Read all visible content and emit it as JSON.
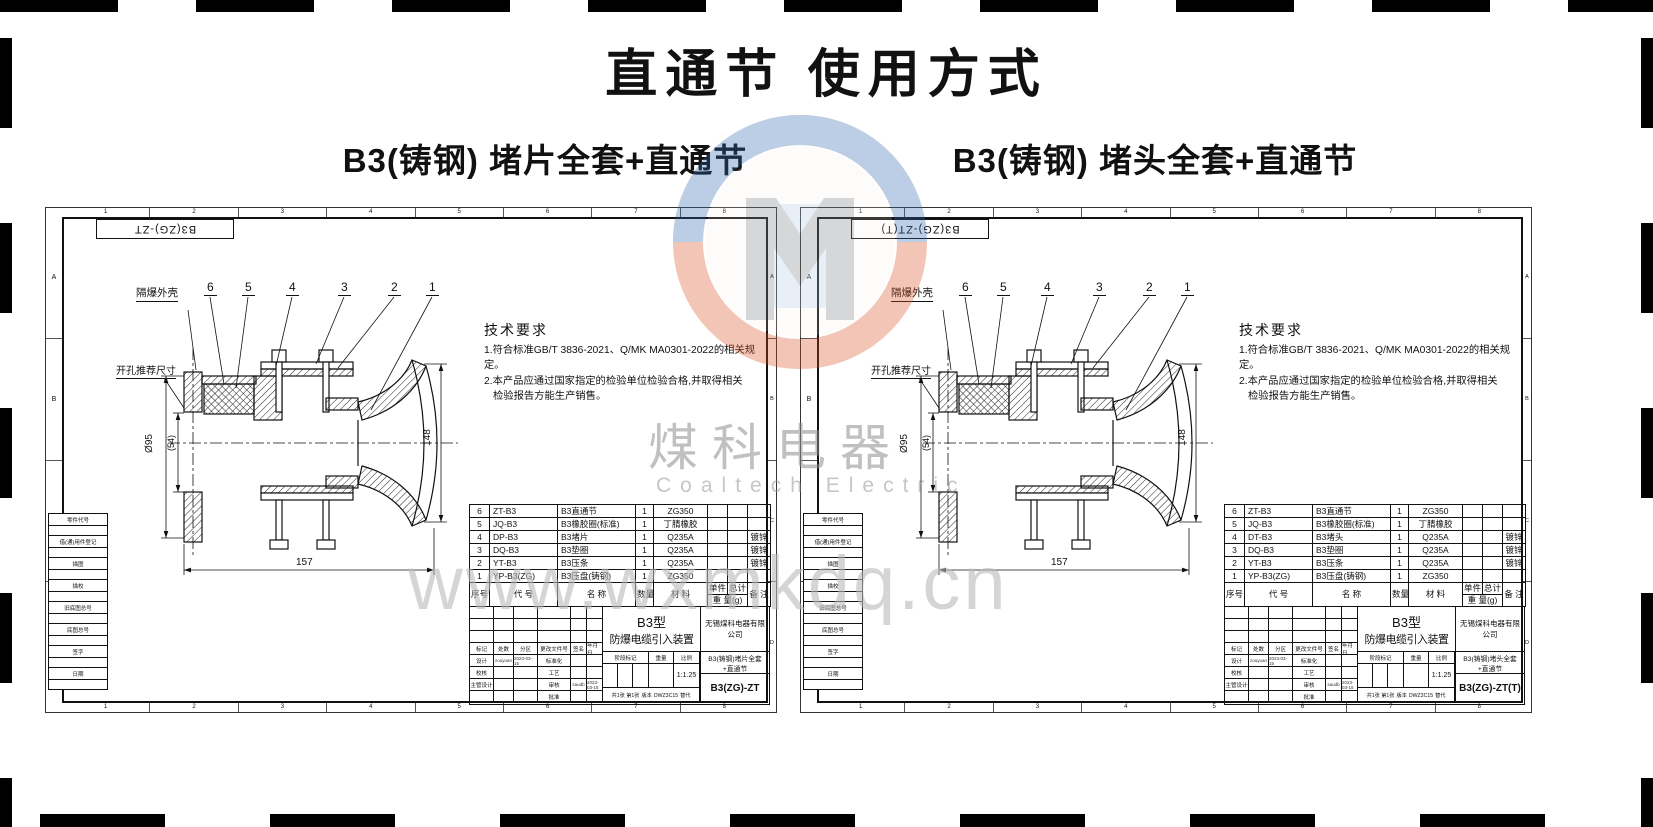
{
  "page": {
    "title": "直通节 使用方式",
    "watermark": {
      "cn": "煤科电器",
      "en": "Coaltech Electric",
      "url": "www.wxmkdq.cn"
    }
  },
  "drawings": [
    {
      "subtitle": "B3(铸钢) 堵片全套+直通节",
      "corner_label": "B3(ZG)-ZT",
      "zone_cols": [
        "1",
        "2",
        "3",
        "4",
        "5",
        "6",
        "7",
        "8"
      ],
      "zone_rows": [
        "A",
        "B",
        "C",
        "D"
      ],
      "margin_labels": {
        "part_code": "零件代号",
        "borrow": "借(通)用件登记",
        "trace": "描图",
        "trace_check": "描校",
        "old_base": "旧底图总号",
        "base": "底图总号",
        "sign": "签字",
        "date": "日期"
      },
      "view": {
        "enclosure_label": "隔爆外壳",
        "hole_label": "开孔推荐尺寸",
        "callouts": [
          "6",
          "5",
          "4",
          "3",
          "2",
          "1"
        ],
        "dims": {
          "d95": "Ø95",
          "d54": "(54)",
          "d148": "148",
          "d157": "157"
        }
      },
      "tech": {
        "title": "技术要求",
        "line1": "1.符合标准GB/T 3836-2021、Q/MK MA0301-2022的相关规定。",
        "line2": "2.本产品应通过国家指定的检验单位检验合格,并取得相关",
        "line3": "检验报告方能生产销售。"
      },
      "table": {
        "headers": {
          "no": "序号",
          "code": "代  号",
          "name": "名  称",
          "qty": "数量",
          "material": "材  料",
          "unit": "单件",
          "total": "总计",
          "weight": "重 量(g)",
          "note": "备 注"
        },
        "rows": [
          {
            "no": "6",
            "code": "ZT-B3",
            "name": "B3直通节",
            "qty": "1",
            "material": "ZG350",
            "unit": "",
            "total": "",
            "note": ""
          },
          {
            "no": "5",
            "code": "JQ-B3",
            "name": "B3橡胶圈(标准)",
            "qty": "1",
            "material": "丁腈橡胶",
            "unit": "",
            "total": "",
            "note": ""
          },
          {
            "no": "4",
            "code": "DP-B3",
            "name": "B3堵片",
            "qty": "1",
            "material": "Q235A",
            "unit": "",
            "total": "",
            "note": "镀锌"
          },
          {
            "no": "3",
            "code": "DQ-B3",
            "name": "B3垫圈",
            "qty": "1",
            "material": "Q235A",
            "unit": "",
            "total": "",
            "note": "镀锌"
          },
          {
            "no": "2",
            "code": "YT-B3",
            "name": "B3压条",
            "qty": "1",
            "material": "Q235A",
            "unit": "",
            "total": "",
            "note": "镀锌"
          },
          {
            "no": "1",
            "code": "YP-B3(ZG)",
            "name": "B3压盘(铸钢)",
            "qty": "1",
            "material": "ZG350",
            "unit": "",
            "total": "",
            "note": ""
          }
        ]
      },
      "tb": {
        "rev_headers": {
          "mark": "标记",
          "count": "处数",
          "zone": "分区",
          "doc": "更改文件号",
          "sign": "签名",
          "date": "年月日"
        },
        "roles": {
          "design": "设计",
          "standard": "标准化",
          "check": "校核",
          "craft": "工艺",
          "chief": "主管设计",
          "audit": "审核",
          "approve": "批准"
        },
        "design_sign": "zouyuan",
        "design_date": "2023-03-15",
        "audit_sign": "saudb",
        "audit_date": "2023-03-15",
        "stage": "阶段标记",
        "weight": "重量",
        "scale": "比例",
        "scale_value": "1:1.25",
        "type": "B3型",
        "product": "防爆电缆引入装置",
        "company": "无锡煤科电器有限公司",
        "drawing_title": "B3(铸钢)堵片全套+直通节",
        "drawing_no": "B3(ZG)-ZT",
        "sheet": "共1张 第1张",
        "version_label": "版本",
        "version": "DWZ3C15",
        "replace_label": "替代"
      }
    },
    {
      "subtitle": "B3(铸钢) 堵头全套+直通节",
      "corner_label": "B3(ZG)-ZT(T)",
      "zone_cols": [
        "1",
        "2",
        "3",
        "4",
        "5",
        "6",
        "7",
        "8"
      ],
      "zone_rows": [
        "A",
        "B",
        "C",
        "D"
      ],
      "margin_labels": {
        "part_code": "零件代号",
        "borrow": "借(通)用件登记",
        "trace": "描图",
        "trace_check": "描校",
        "old_base": "旧底图总号",
        "base": "底图总号",
        "sign": "签字",
        "date": "日期"
      },
      "view": {
        "enclosure_label": "隔爆外壳",
        "hole_label": "开孔推荐尺寸",
        "callouts": [
          "6",
          "5",
          "4",
          "3",
          "2",
          "1"
        ],
        "dims": {
          "d95": "Ø95",
          "d54": "(54)",
          "d148": "148",
          "d157": "157"
        }
      },
      "tech": {
        "title": "技术要求",
        "line1": "1.符合标准GB/T 3836-2021、Q/MK MA0301-2022的相关规定。",
        "line2": "2.本产品应通过国家指定的检验单位检验合格,并取得相关",
        "line3": "检验报告方能生产销售。"
      },
      "table": {
        "headers": {
          "no": "序号",
          "code": "代  号",
          "name": "名  称",
          "qty": "数量",
          "material": "材  料",
          "unit": "单件",
          "total": "总计",
          "weight": "重 量(g)",
          "note": "备 注"
        },
        "rows": [
          {
            "no": "6",
            "code": "ZT-B3",
            "name": "B3直通节",
            "qty": "1",
            "material": "ZG350",
            "unit": "",
            "total": "",
            "note": ""
          },
          {
            "no": "5",
            "code": "JQ-B3",
            "name": "B3橡胶圈(标准)",
            "qty": "1",
            "material": "丁腈橡胶",
            "unit": "",
            "total": "",
            "note": ""
          },
          {
            "no": "4",
            "code": "DT-B3",
            "name": "B3堵头",
            "qty": "1",
            "material": "Q235A",
            "unit": "",
            "total": "",
            "note": "镀锌"
          },
          {
            "no": "3",
            "code": "DQ-B3",
            "name": "B3垫圈",
            "qty": "1",
            "material": "Q235A",
            "unit": "",
            "total": "",
            "note": "镀锌"
          },
          {
            "no": "2",
            "code": "YT-B3",
            "name": "B3压条",
            "qty": "1",
            "material": "Q235A",
            "unit": "",
            "total": "",
            "note": "镀锌"
          },
          {
            "no": "1",
            "code": "YP-B3(ZG)",
            "name": "B3压盘(铸钢)",
            "qty": "1",
            "material": "ZG350",
            "unit": "",
            "total": "",
            "note": ""
          }
        ]
      },
      "tb": {
        "rev_headers": {
          "mark": "标记",
          "count": "处数",
          "zone": "分区",
          "doc": "更改文件号",
          "sign": "签名",
          "date": "年月日"
        },
        "roles": {
          "design": "设计",
          "standard": "标准化",
          "check": "校核",
          "craft": "工艺",
          "chief": "主管设计",
          "audit": "审核",
          "approve": "批准"
        },
        "design_sign": "zouyuan",
        "design_date": "2023-03-15",
        "audit_sign": "saudb",
        "audit_date": "2023-03-15",
        "stage": "阶段标记",
        "weight": "重量",
        "scale": "比例",
        "scale_value": "1:1.25",
        "type": "B3型",
        "product": "防爆电缆引入装置",
        "company": "无锡煤科电器有限公司",
        "drawing_title": "B3(铸钢)堵头全套+直通节",
        "drawing_no": "B3(ZG)-ZT(T)",
        "sheet": "共1张 第1张",
        "version_label": "版本",
        "version": "DWZ3C15",
        "replace_label": "替代"
      }
    }
  ]
}
